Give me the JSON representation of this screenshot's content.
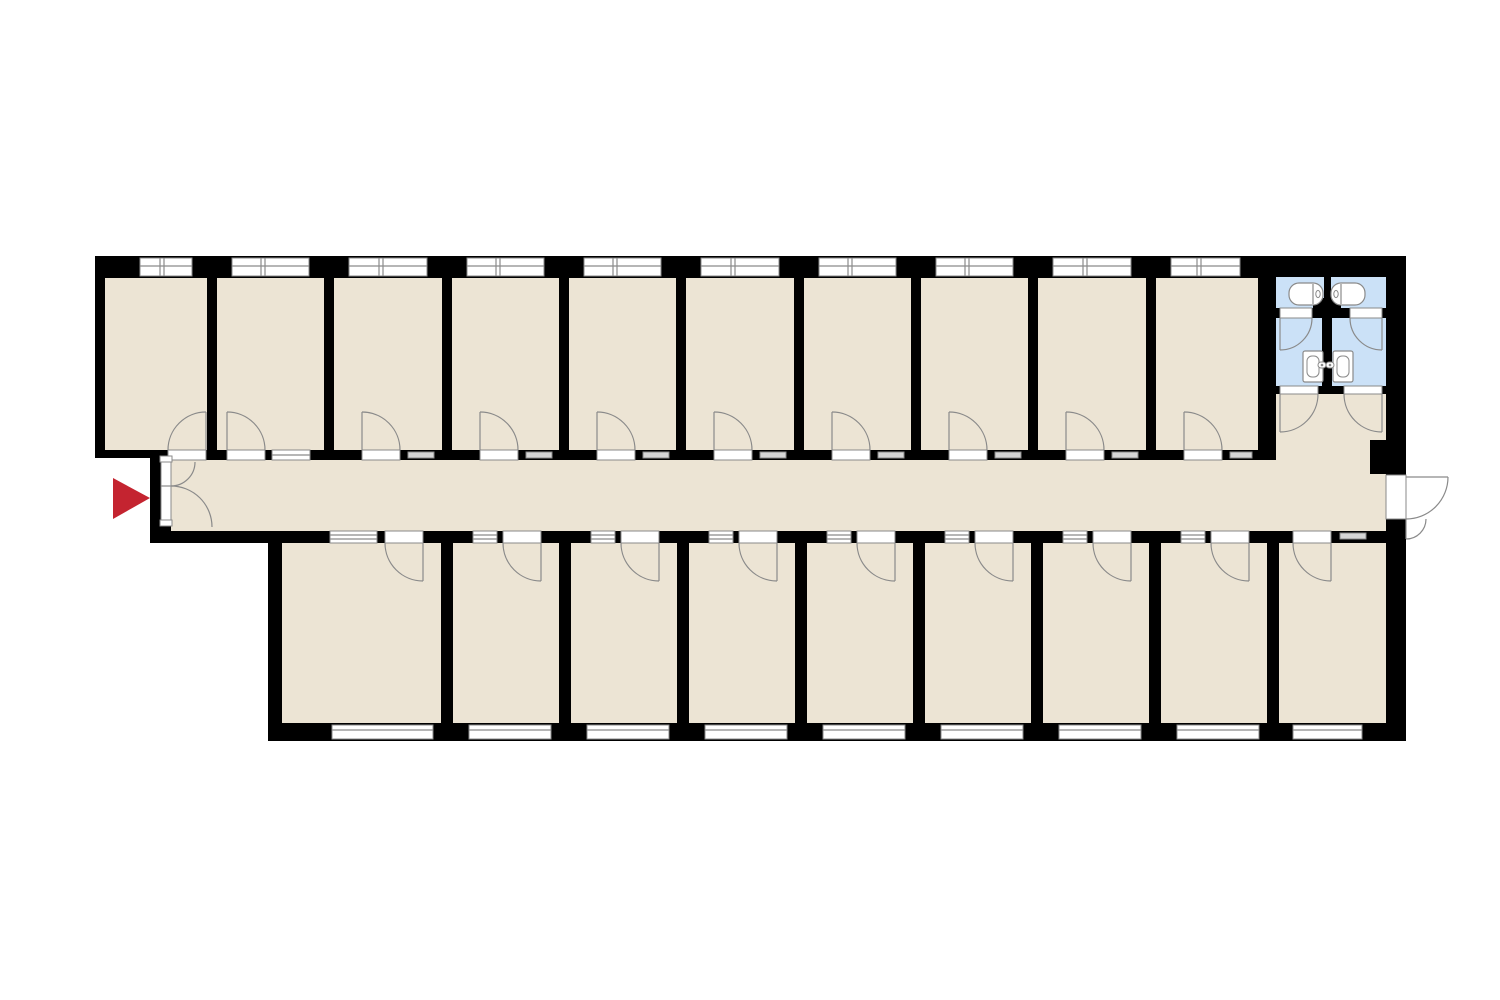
{
  "canvas": {
    "width": 1500,
    "height": 1000,
    "background": "#ffffff"
  },
  "colors": {
    "wall": "#000000",
    "floor": "#ece4d4",
    "wet": "#cbe1f7",
    "line": "#8a8a8a",
    "vent_fill": "#d6d6d6",
    "fixture": "#ffffff",
    "arrow": "#c42430",
    "window": "#ffffff"
  },
  "counts": {
    "top_rooms": 10,
    "bottom_rooms": 9,
    "bath_units": 2,
    "bathtubs": 2,
    "toilets": 2,
    "wc_stalls": 2,
    "entrances": 2
  },
  "plan": {
    "outline": [
      [
        95,
        256
      ],
      [
        1406,
        256
      ],
      [
        1406,
        741
      ],
      [
        268,
        741
      ],
      [
        268,
        543
      ],
      [
        150,
        543
      ],
      [
        150,
        455
      ],
      [
        95,
        455
      ]
    ],
    "bands": {
      "top_window": {
        "y1": 258,
        "y2": 276,
        "mid": 266
      },
      "top_rooms": {
        "y1": 278,
        "y2": 450
      },
      "top_wall": {
        "y1": 450,
        "y2": 460
      },
      "corridor": {
        "x1": 171,
        "x2": 1386,
        "y1": 460,
        "y2": 531
      },
      "bottom_wall": {
        "y1": 531,
        "y2": 543
      },
      "bottom_rooms": {
        "y1": 543,
        "y2": 723
      },
      "bottom_window": {
        "y1": 725,
        "y2": 739,
        "mid": 730
      }
    },
    "door_radius": 38,
    "top_rooms": [
      {
        "x1": 105,
        "x2": 207,
        "door": [
          168,
          206
        ],
        "hinge": "right",
        "window": [
          140,
          192
        ]
      },
      {
        "x1": 217,
        "x2": 324,
        "door": [
          227,
          265
        ],
        "hinge": "left",
        "sidelight": [
          272,
          310
        ],
        "window": [
          232,
          309
        ]
      },
      {
        "x1": 334,
        "x2": 442,
        "door": [
          362,
          400
        ],
        "hinge": "left",
        "vent": [
          408,
          434
        ],
        "window": [
          349,
          427
        ]
      },
      {
        "x1": 452,
        "x2": 559,
        "door": [
          480,
          518
        ],
        "hinge": "left",
        "vent": [
          526,
          552
        ],
        "window": [
          467,
          544
        ]
      },
      {
        "x1": 569,
        "x2": 676,
        "door": [
          597,
          635
        ],
        "hinge": "left",
        "vent": [
          643,
          669
        ],
        "window": [
          584,
          661
        ]
      },
      {
        "x1": 686,
        "x2": 794,
        "door": [
          714,
          752
        ],
        "hinge": "left",
        "vent": [
          760,
          786
        ],
        "window": [
          701,
          779
        ]
      },
      {
        "x1": 804,
        "x2": 911,
        "door": [
          832,
          870
        ],
        "hinge": "left",
        "vent": [
          878,
          904
        ],
        "window": [
          819,
          896
        ]
      },
      {
        "x1": 921,
        "x2": 1028,
        "door": [
          949,
          987
        ],
        "hinge": "left",
        "vent": [
          995,
          1021
        ],
        "window": [
          936,
          1013
        ]
      },
      {
        "x1": 1038,
        "x2": 1146,
        "door": [
          1066,
          1104
        ],
        "hinge": "left",
        "vent": [
          1112,
          1138
        ],
        "window": [
          1053,
          1131
        ]
      },
      {
        "x1": 1156,
        "x2": 1258,
        "door": [
          1184,
          1222
        ],
        "hinge": "left",
        "vent": [
          1230,
          1252
        ],
        "window": [
          1171,
          1240
        ]
      }
    ],
    "bottom_rooms": [
      {
        "x1": 282,
        "x2": 441,
        "sidelight": [
          330,
          377
        ],
        "door": [
          385,
          423
        ],
        "window": [
          332,
          433
        ]
      },
      {
        "x1": 453,
        "x2": 559,
        "sidelight": [
          473,
          497
        ],
        "door": [
          503,
          541
        ],
        "window": [
          469,
          551
        ]
      },
      {
        "x1": 571,
        "x2": 677,
        "sidelight": [
          591,
          615
        ],
        "door": [
          621,
          659
        ],
        "window": [
          587,
          669
        ]
      },
      {
        "x1": 689,
        "x2": 795,
        "sidelight": [
          709,
          733
        ],
        "door": [
          739,
          777
        ],
        "window": [
          705,
          787
        ]
      },
      {
        "x1": 807,
        "x2": 913,
        "sidelight": [
          827,
          851
        ],
        "door": [
          857,
          895
        ],
        "window": [
          823,
          905
        ]
      },
      {
        "x1": 925,
        "x2": 1031,
        "sidelight": [
          945,
          969
        ],
        "door": [
          975,
          1013
        ],
        "window": [
          941,
          1023
        ]
      },
      {
        "x1": 1043,
        "x2": 1149,
        "sidelight": [
          1063,
          1087
        ],
        "door": [
          1093,
          1131
        ],
        "window": [
          1059,
          1141
        ]
      },
      {
        "x1": 1161,
        "x2": 1267,
        "sidelight": [
          1181,
          1205
        ],
        "door": [
          1211,
          1249
        ],
        "window": [
          1177,
          1259
        ]
      },
      {
        "x1": 1279,
        "x2": 1386,
        "door": [
          1293,
          1331
        ],
        "vent": [
          1340,
          1366
        ],
        "window": [
          1293,
          1362
        ]
      }
    ],
    "vestibule": {
      "x1": 1276,
      "x2": 1386,
      "y1": 394,
      "y2": 460
    },
    "step": [
      95,
      436,
      58,
      22
    ],
    "pillar": [
      1370,
      440,
      16,
      34
    ],
    "entrance": {
      "strip": [
        161,
        457,
        10,
        69
      ],
      "frames": [
        [
          160,
          456,
          12,
          6
        ],
        [
          160,
          520,
          12,
          6
        ]
      ],
      "divider_y": 486,
      "arcs": [
        "M171,486 A24 24 0 0 0 195,462",
        "M171,486 A41 41 0 0 1 212,527"
      ]
    },
    "exit": {
      "gap": [
        1386,
        475,
        20,
        44
      ],
      "leaves": [
        "M1406,477 L1448,477",
        "M1406,519 L1406,539"
      ],
      "arcs": [
        "M1448,477 A42 42 0 0 1 1406,519",
        "M1426,519 A20 20 0 0 1 1406,539"
      ]
    },
    "bathroom": {
      "sink_room_left": [
        1276,
        277,
        48,
        31
      ],
      "sink_room_right": [
        1331,
        277,
        55,
        31
      ],
      "stub": [
        1313,
        298,
        28,
        20
      ],
      "stall_left": [
        1276,
        318,
        46,
        68
      ],
      "stall_right": [
        1332,
        318,
        54,
        68
      ],
      "stall_door_gaps": [
        [
          1280,
          308,
          32,
          10
        ],
        [
          1350,
          308,
          32,
          10
        ]
      ],
      "stall_door_leaves": [
        "M1280,318 L1280,350",
        "M1382,318 L1382,350"
      ],
      "stall_door_arcs": [
        "M1280,350 A32 32 0 0 0 1312,318",
        "M1382,350 A32 32 0 0 1 1350,318"
      ],
      "lower_gaps": [
        [
          1280,
          386,
          38,
          8
        ],
        [
          1344,
          386,
          38,
          8
        ]
      ],
      "vest_door_leaves": [
        "M1280,394 L1280,432",
        "M1382,394 L1382,432"
      ],
      "vest_door_arcs": [
        "M1280,432 A38 38 0 0 0 1318,394",
        "M1382,432 A38 38 0 0 1 1344,394"
      ],
      "tubs": [
        {
          "x": 1289,
          "y": 283,
          "w": 34,
          "h": 22,
          "divider": 1313,
          "knob": 1318
        },
        {
          "x": 1331,
          "y": 283,
          "w": 34,
          "h": 22,
          "divider": 1341,
          "knob": 1336
        }
      ],
      "toilets": [
        {
          "x": 1303,
          "y": 351,
          "w": 20,
          "h": 31,
          "handle": [
            1318,
            362
          ]
        },
        {
          "x": 1333,
          "y": 351,
          "w": 20,
          "h": 31,
          "handle": [
            1326,
            362
          ]
        }
      ]
    },
    "entrance_marker": {
      "type": "arrow",
      "points": [
        [
          113,
          478
        ],
        [
          150,
          498
        ],
        [
          113,
          519
        ]
      ],
      "meaning": "main entrance"
    }
  }
}
